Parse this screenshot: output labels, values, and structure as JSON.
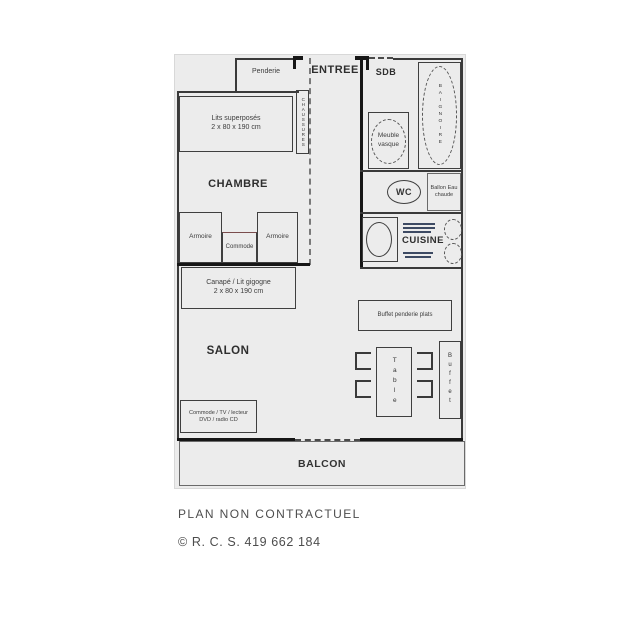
{
  "plan": {
    "entree": {
      "label": "ENTREE",
      "penderie": "Penderie",
      "chaussures": "CHAUSSURES"
    },
    "chambre": {
      "label": "CHAMBRE",
      "bed_line1": "Lits superposés",
      "bed_line2": "2 x 80 x 190 cm",
      "armoire_left": "Armoire",
      "commode": "Commode",
      "armoire_right": "Armoire"
    },
    "sdb": {
      "label": "SDB",
      "vasque_line1": "Meuble",
      "vasque_line2": "vasque",
      "baignoire": "BAIGNOIRE"
    },
    "wc": {
      "label": "WC",
      "ballon_line1": "Ballon Eau",
      "ballon_line2": "chaude"
    },
    "cuisine": {
      "label": "CUISINE"
    },
    "salon": {
      "label": "SALON",
      "sofa_line1": "Canapé / Lit gigogne",
      "sofa_line2": "2 x 80 x 190 cm",
      "tv_line1": "Commode / TV / lecteur",
      "tv_line2": "DVD / radio CD",
      "buffet_haut": "Buffet penderie plats",
      "table": "Table",
      "buffet": "Buffet"
    },
    "balcon": {
      "label": "BALCON"
    }
  },
  "footer": {
    "line1": "PLAN NON CONTRACTUEL",
    "line2": "© R. C. S. 419 662 184"
  },
  "colors": {
    "plan_bg": "#ececec",
    "wall": "#3a3a3a",
    "text": "#3a3a3a"
  }
}
